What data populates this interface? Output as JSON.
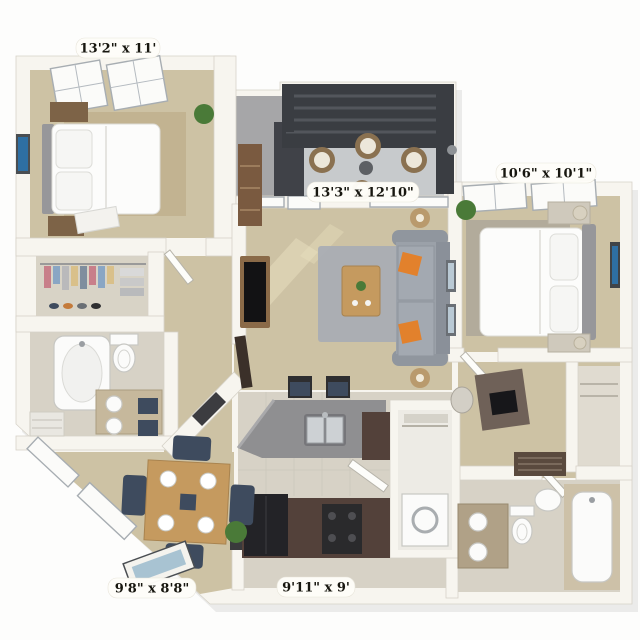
{
  "floorplan": {
    "type": "3d-apartment-floor-plan",
    "labels": [
      {
        "room": "bedroom-1",
        "text": "13'2\" x 11'"
      },
      {
        "room": "bedroom-2",
        "text": "10'6\" x 10'1\""
      },
      {
        "room": "living-room",
        "text": "13'3\" x 12'10\""
      },
      {
        "room": "dining-room",
        "text": "9'8\" x 8'8\""
      },
      {
        "room": "kitchen",
        "text": "9'11\" x 9'"
      }
    ],
    "colors": {
      "carpet": "#cdc2a4",
      "rug_dark": "#c2b391",
      "tile": "#d7d2c6",
      "concrete": "#c7cacc",
      "wall": "#f7f5ef",
      "pergola": "#3a3d42",
      "sofa": "#9ba1a9",
      "accent": "#e2812c",
      "wood": "#c59a5f",
      "navy": "#3e4b5e",
      "counter": "#8f8f91",
      "cabinet": "#53413a",
      "appliance": "#232327",
      "art": "#2e6fa3",
      "plant": "#4a7a38",
      "gray_rug": "#a8adb4"
    }
  }
}
